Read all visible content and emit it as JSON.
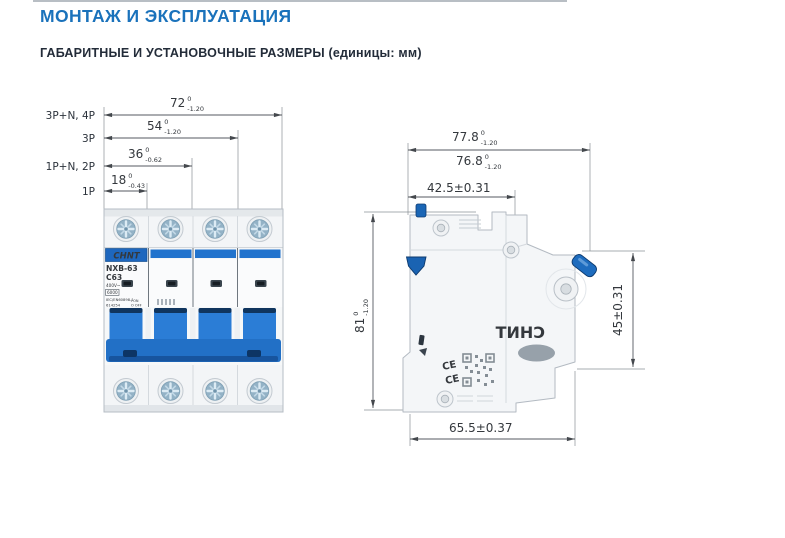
{
  "header": {
    "title": "МОНТАЖ И ЭКСПЛУАТАЦИЯ",
    "subtitle": "ГАБАРИТНЫЕ И УСТАНОВОЧНЫЕ РАЗМЕРЫ (единицы: мм)"
  },
  "front_view": {
    "rows": [
      {
        "config": "3P+N, 4P",
        "value": "72",
        "sup": "0",
        "sub": "-1.20"
      },
      {
        "config": "3P",
        "value": "54",
        "sup": "0",
        "sub": "-1.20"
      },
      {
        "config": "1P+N, 2P",
        "value": "36",
        "sup": "0",
        "sub": "-0.62"
      },
      {
        "config": "1P",
        "value": "18",
        "sup": "0",
        "sub": "-0.43"
      }
    ],
    "breaker": {
      "brand": "CHNT",
      "model": "NXB-63",
      "rating": "C63",
      "voltage": "400V~",
      "capacity": "6000",
      "standard": "IEC/EN60898-1",
      "code": "614254",
      "on": "I ON",
      "off": "O OFF"
    }
  },
  "side_view": {
    "dim_width_total": {
      "value": "77.8",
      "sup": "0",
      "sub": "-1.20"
    },
    "dim_width_body": {
      "value": "76.8",
      "sup": "0",
      "sub": "-1.20"
    },
    "dim_top_depth": {
      "value": "42.5±0.31"
    },
    "dim_height": {
      "value": "81",
      "sup": "0",
      "sub": "-1.20"
    },
    "dim_rail_height": {
      "value": "45±0.31"
    },
    "dim_bottom_depth": {
      "value": "65.5±0.37"
    },
    "ce_mark": "CE",
    "watermark": "CHNT"
  },
  "colors": {
    "accent": "#1a72bb",
    "heading_text": "#232c39",
    "brand_blue": "#2173cd",
    "dim_line": "#555a60"
  }
}
